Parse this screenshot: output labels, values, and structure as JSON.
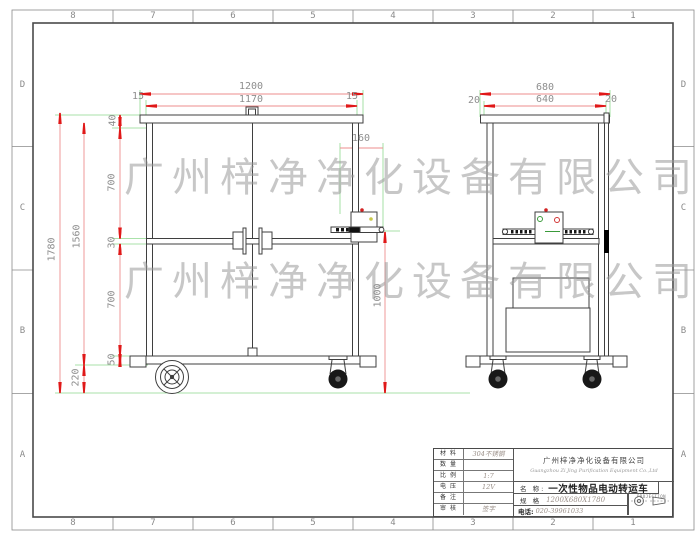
{
  "sheet": {
    "cols": [
      "8",
      "7",
      "6",
      "5",
      "4",
      "3",
      "2",
      "1"
    ],
    "rows": [
      "D",
      "C",
      "B",
      "A"
    ]
  },
  "watermark": {
    "text": "广州梓净净化设备有限公司"
  },
  "dims": {
    "front_total_width": "1200",
    "front_inner_width": "1170",
    "front_margin_left": "15",
    "front_margin_right": "15",
    "height_total": "1780",
    "height_body": "1560",
    "seg_top": "40",
    "seg_upper": "700",
    "seg_rail": "30",
    "seg_lower": "700",
    "seg_bottom": "50",
    "wheel_height": "220",
    "box_offset": "160",
    "box_ground_height": "1000",
    "side_total_width": "680",
    "side_inner_width": "640",
    "side_margin_left": "20",
    "side_margin_right": "20"
  },
  "title_block": {
    "material_label": "材 料",
    "material_value": "304不锈钢",
    "quantity_label": "数 量",
    "quantity_value": "",
    "scale_label": "比 例",
    "scale_value": "1:7",
    "voltage_label": "电 压",
    "voltage_value": "12V",
    "remark_label": "备 注",
    "remark_value": "",
    "check_label": "审 核",
    "check_value": "签字",
    "company_cn": "广州梓净净化设备有限公司",
    "company_en": "Guangzhou Zi Jing Purification Equipment Co.,Ltd",
    "name_label": "名  称:",
    "name_value": "一次性物品电动转运车",
    "spec_label": "规  格",
    "spec_value": "1200X680X1780",
    "phone_label": "电话:",
    "phone_value": "020-39961033",
    "projection_label": "PROJECTION"
  },
  "colors": {
    "dim_arrow_red": "#e01818",
    "dim_line_red": "#ee8d8d",
    "extension_green": "#8ed88e",
    "drawing_line": "#3f3f3f",
    "dim_text_gray": "#8e8e8e",
    "watermark_gray": "#9b9b9b"
  }
}
